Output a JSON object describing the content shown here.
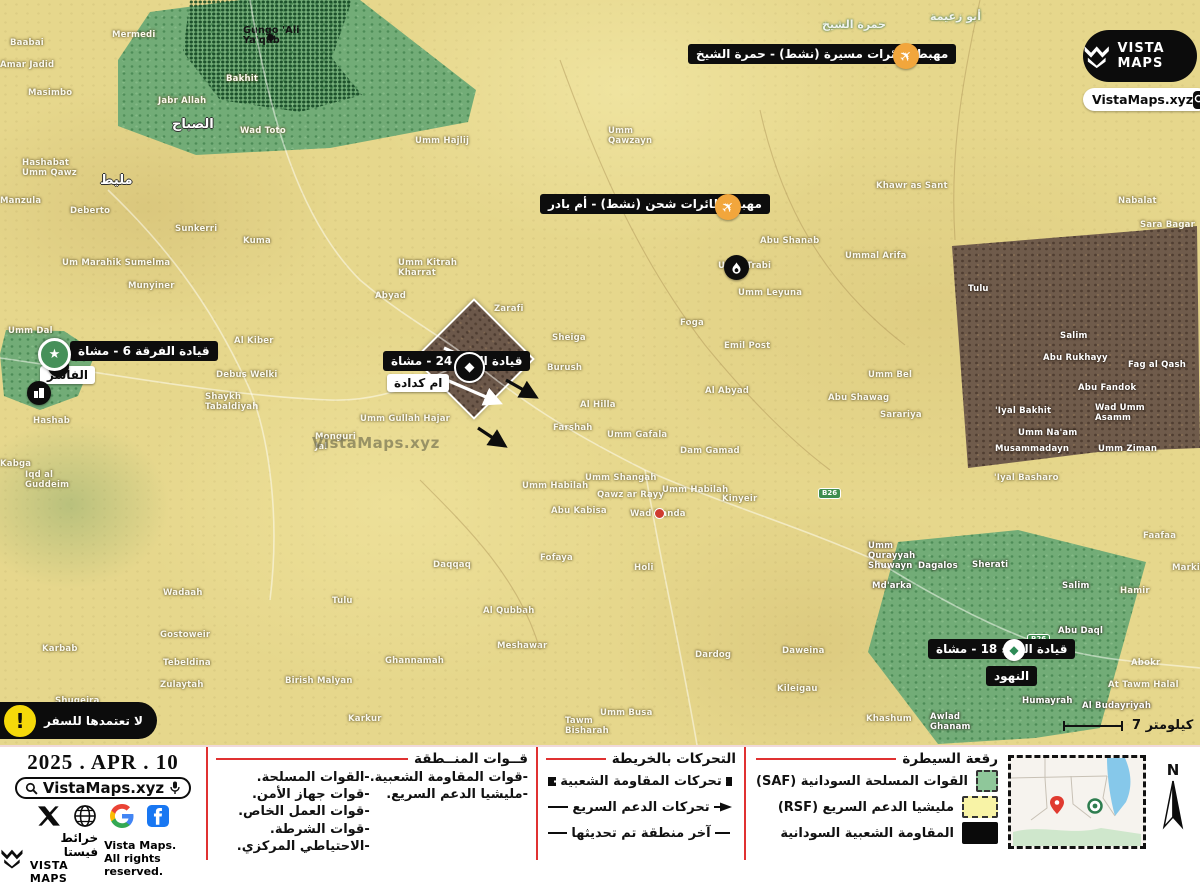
{
  "brand": {
    "logo_title": "VISTA MAPS",
    "site": "VistaMaps.xyz",
    "footer_brand_ar": "خرائط فيستا",
    "footer_brand_en": "VISTA MAPS",
    "rights_line1": "Vista Maps.",
    "rights_line2": "All rights reserved."
  },
  "date": "2025 . APR . 10",
  "search": {
    "site": "VistaMaps.xyz"
  },
  "map": {
    "watermark": "VistaMaps.xyz",
    "scale_label": "كيلومتر 7",
    "north_label": "N",
    "warning": "لا تعتمدها للسفر",
    "road_badge": "B26",
    "road_badge_positions": [
      [
        401,
        378
      ],
      [
        818,
        488
      ],
      [
        1027,
        634
      ]
    ],
    "callouts": {
      "drone_airstrip": "مهبط طائرات مسيرة (نشط) - حمرة الشيخ",
      "cargo_airstrip": "مهبط طائرات شحن (نشط) - أم بادر",
      "div6_hq": "قيادة الفرقة 6 - مشاة",
      "bde24_hq": "قيادة اللواء 24 - مشاة",
      "bde18_hq": "قيادة اللواء 18 - مشاة",
      "el_fasher": "الفاشر",
      "umm_keddada": "ام كدادة",
      "en_nahud": "النهود"
    },
    "place_labels": [
      [
        "Baabai",
        10,
        38
      ],
      [
        "Amar Jadid",
        0,
        60
      ],
      [
        "Masimbo",
        28,
        88
      ],
      [
        "Mermedi",
        112,
        30
      ],
      [
        "Gungo 'Ali\nYa'qub",
        243,
        26,
        "pd"
      ],
      [
        "Bakhit",
        226,
        74
      ],
      [
        "Jabr Allah",
        158,
        96
      ],
      [
        "Wad Toto",
        240,
        126
      ],
      [
        "الصباح",
        172,
        120,
        "ar"
      ],
      [
        "Umm Hajlij",
        415,
        136
      ],
      [
        "Umm\nQawzayn",
        608,
        126
      ],
      [
        "حمرة الشيخ",
        822,
        20,
        "arf"
      ],
      [
        "أبو زعيمة",
        930,
        12,
        "arf"
      ],
      [
        "Khawr as Sant",
        876,
        181
      ],
      [
        "Nabalat",
        1118,
        196
      ],
      [
        "Sara Bagar",
        1140,
        220
      ],
      [
        "Hashabat\nUmm Qawz",
        22,
        158
      ],
      [
        "مليط",
        100,
        176,
        "ar"
      ],
      [
        "Manzula",
        0,
        196
      ],
      [
        "Deberto",
        70,
        206
      ],
      [
        "Sunkerri",
        175,
        224
      ],
      [
        "Kuma",
        243,
        236
      ],
      [
        "Um Marahik Sumelma",
        62,
        258
      ],
      [
        "Munyiner",
        128,
        281
      ],
      [
        "Umm Kitrah\nKharrat",
        398,
        258
      ],
      [
        "Abyad",
        375,
        291
      ],
      [
        "Abu Shanab",
        760,
        236
      ],
      [
        "Umm Trabi",
        718,
        261
      ],
      [
        "Ummal Arifa",
        845,
        251
      ],
      [
        "Umm Leyuna",
        738,
        288
      ],
      [
        "Foga",
        680,
        318
      ],
      [
        "Emil Post",
        724,
        341
      ],
      [
        "Tulu",
        968,
        284,
        "pw"
      ],
      [
        "Salim",
        1060,
        331,
        "pw"
      ],
      [
        "Abu Rukhayy",
        1043,
        353,
        "pw"
      ],
      [
        "Fag al Qash",
        1128,
        360,
        "pw"
      ],
      [
        "Abu Fandok",
        1078,
        383,
        "pw"
      ],
      [
        "'Iyal Bakhit",
        995,
        406,
        "pw"
      ],
      [
        "Wad Umm\nAsamm",
        1095,
        403,
        "pw"
      ],
      [
        "Umm Na'am",
        1018,
        428,
        "pw"
      ],
      [
        "Musammadayn",
        995,
        444,
        "pw"
      ],
      [
        "Umm Ziman",
        1098,
        444,
        "pw"
      ],
      [
        "Sarariya",
        880,
        410
      ],
      [
        "Abu Shawag",
        828,
        393
      ],
      [
        "Umm Bel",
        868,
        370
      ],
      [
        "Al Abyad",
        705,
        386
      ],
      [
        "'Iyal Basharo",
        994,
        473
      ],
      [
        "Umm Dal",
        8,
        326
      ],
      [
        "Shaykh\nTabaldiyah",
        205,
        392
      ],
      [
        "Hashab",
        33,
        416
      ],
      [
        "Kabga",
        0,
        459
      ],
      [
        "Iqd al\nGuddeim",
        25,
        470
      ],
      [
        "Al Kiber",
        234,
        336
      ],
      [
        "Sharafiya",
        170,
        348
      ],
      [
        "Debus Welki",
        216,
        370
      ],
      [
        "Monguri\nJal",
        315,
        432
      ],
      [
        "Umm Gullah Hajar",
        360,
        414
      ],
      [
        "Zarafi",
        494,
        304
      ],
      [
        "Sheiga",
        552,
        333
      ],
      [
        "Burush",
        547,
        363
      ],
      [
        "Al Hilla",
        580,
        400
      ],
      [
        "Farshah",
        553,
        423
      ],
      [
        "Umm Gafala",
        607,
        430
      ],
      [
        "Dam Gamad",
        680,
        446
      ],
      [
        "Umm Shangah",
        585,
        473
      ],
      [
        "Qawz ar Rayy",
        597,
        490
      ],
      [
        "Umm Habilah",
        522,
        481
      ],
      [
        "Abu Kabisa",
        551,
        506
      ],
      [
        "Umm Habilah",
        662,
        485
      ],
      [
        "Wad Banda",
        630,
        509
      ],
      [
        "Kinyeir",
        722,
        494
      ],
      [
        "Faafaa",
        1143,
        531
      ],
      [
        "Markib",
        1172,
        563
      ],
      [
        "Umm\nQurayyah\nShuwayn",
        868,
        541,
        "pw"
      ],
      [
        "Dagalos",
        918,
        561,
        "pw"
      ],
      [
        "Sherati",
        972,
        560,
        "pw"
      ],
      [
        "Salim",
        1062,
        581,
        "pw"
      ],
      [
        "Hamir",
        1120,
        586
      ],
      [
        "Fofaya",
        540,
        553
      ],
      [
        "Holi",
        634,
        563
      ],
      [
        "Md'arka",
        872,
        581,
        "pw"
      ],
      [
        "Daqqaq",
        433,
        560
      ],
      [
        "Tulu",
        332,
        596
      ],
      [
        "Al Qubbah",
        483,
        606
      ],
      [
        "Meshawar",
        497,
        641
      ],
      [
        "Abu Daql",
        1058,
        626,
        "pw"
      ],
      [
        "Abokr",
        1131,
        658
      ],
      [
        "At Tawm Halal",
        1108,
        680
      ],
      [
        "Wadaah",
        163,
        588
      ],
      [
        "Gostoweir",
        160,
        630
      ],
      [
        "Karbab",
        42,
        644
      ],
      [
        "Tebeldina",
        163,
        658
      ],
      [
        "Zulaytah",
        160,
        680
      ],
      [
        "Birish Malyan",
        285,
        676
      ],
      [
        "Ghannamah",
        385,
        656
      ],
      [
        "Karkur",
        348,
        714
      ],
      [
        "Umm Busa",
        600,
        708
      ],
      [
        "Tawm\nBisharah",
        565,
        716
      ],
      [
        "Dardog",
        695,
        650
      ],
      [
        "Daweina",
        782,
        646
      ],
      [
        "Kileigau",
        777,
        684
      ],
      [
        "Humayrah",
        1022,
        696,
        "pw"
      ],
      [
        "Al Budayriyah",
        1082,
        701,
        "pw"
      ],
      [
        "Shugeira",
        55,
        696
      ],
      [
        "Shaqq al\nGawad",
        25,
        710
      ],
      [
        "Khashum",
        866,
        714
      ],
      [
        "Awlad\nGhanam",
        930,
        712,
        "pw"
      ]
    ]
  },
  "footer": {
    "forces": {
      "title": "قــوات المنــطقة",
      "primary": [
        "-القوات المسلحة.",
        "-قوات جهاز الأمن.",
        "-قوات العمل الخاص.",
        "-قوات الشرطة.",
        "-الاحتياطي المركزي."
      ],
      "secondary": [
        "-قوات المقاومة الشعبية.",
        "-مليشيا الدعم السريع."
      ]
    },
    "movements": {
      "title": "التحركات بالخريطة",
      "rows": [
        {
          "label": "تحركات المقاومة الشعبية",
          "glyph": "thick-arrow"
        },
        {
          "label": "تحركات الدعم السريع",
          "glyph": "thin-arrow"
        },
        {
          "label": "آخر منطقة تم تحديثها",
          "glyph": "line"
        }
      ]
    },
    "control": {
      "title": "رقعة السيطرة",
      "rows": [
        {
          "label": "القوات المسلحة السودانية (SAF)",
          "color": "#8fc79a",
          "dashed": true
        },
        {
          "label": "مليشيا الدعم السريع (RSF)",
          "color": "#f8f3a6",
          "dashed": true
        },
        {
          "label": "المقاومة الشعبية السودانية",
          "color": "#0a0a0a",
          "dashed": false
        }
      ]
    }
  },
  "colors": {
    "accent_red": "#e03131",
    "saf_green": "#72ac77",
    "rsf_yellow": "#e6d78c",
    "resistance_black": "#0a0a0a",
    "contested_brown": "#6f5b4b",
    "marker_orange": "#f2a63c"
  }
}
